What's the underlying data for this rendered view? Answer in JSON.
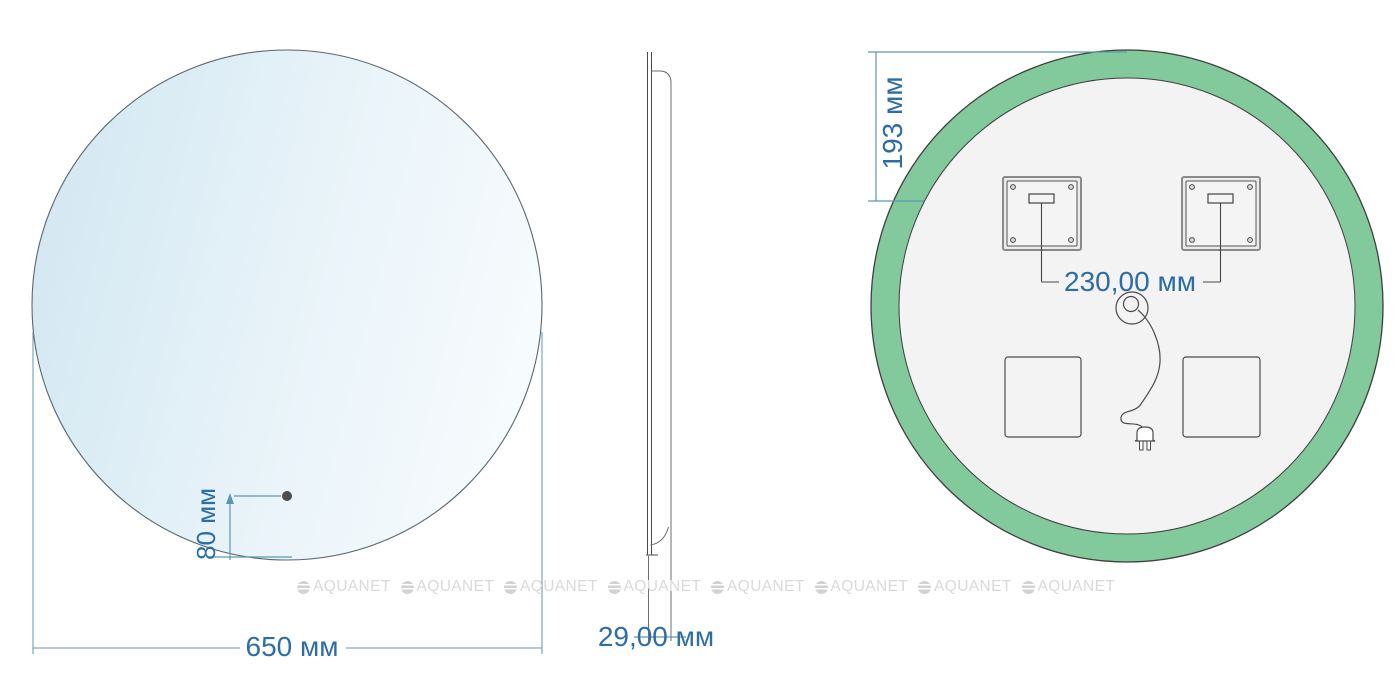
{
  "front": {
    "diameter": "650 мм",
    "sensor_offset": "80 мм"
  },
  "side": {
    "depth": "29,00 мм"
  },
  "back": {
    "top_offset": "193 мм",
    "bracket_spacing": "230,00 мм"
  },
  "watermark": {
    "brand": "AQUANET"
  },
  "colors": {
    "dimension_text": "#2d6da6",
    "dimension_line": "#5b97b5",
    "outline_dark": "#4b4b4b",
    "led_ring_green": "#82c99c",
    "mirror_tint_start": "#d2e7f2",
    "mirror_tint_end": "#f6fbfd",
    "back_panel_fill": "#f3f3f3",
    "watermark_gray": "#d9d9d9"
  }
}
